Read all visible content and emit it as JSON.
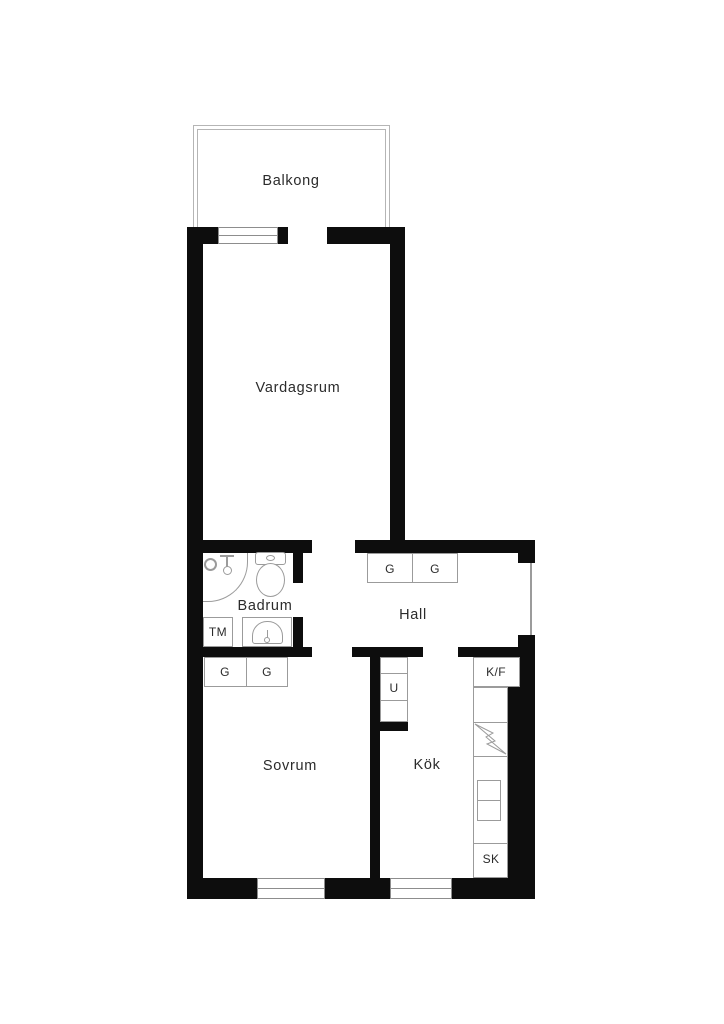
{
  "rooms": {
    "balcony": "Balkong",
    "living_room": "Vardagsrum",
    "bathroom": "Badrum",
    "hall": "Hall",
    "bedroom": "Sovrum",
    "kitchen": "Kök"
  },
  "fixtures": {
    "wardrobe": "G",
    "washing_machine": "TM",
    "oven_unit": "U",
    "fridge_freezer": "K/F",
    "cabinet": "SK"
  },
  "colors": {
    "wall": "#0d0d0d",
    "fixture_line": "#9b9b9b",
    "balcony_line": "#b5b5b5",
    "text": "#2b2b2b",
    "background": "#ffffff"
  }
}
